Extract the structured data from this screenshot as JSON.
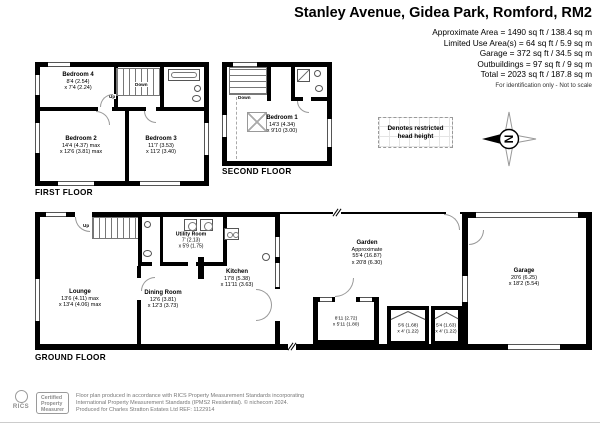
{
  "header": {
    "title": "Stanley Avenue, Gidea Park, Romford, RM2",
    "area_lines": [
      "Approximate Area = 1490 sq ft / 138.4 sq m",
      "Limited Use Area(s) = 64 sq ft / 5.9 sq m",
      "Garage = 372 sq ft / 34.5 sq m",
      "Outbuildings = 97 sq ft / 9 sq m",
      "Total = 2023 sq ft / 187.8 sq m"
    ],
    "disclaimer": "For identification only - Not to scale"
  },
  "legend": {
    "restricted_line1": "Denotes restricted",
    "restricted_line2": "head height",
    "compass_letter": "N"
  },
  "floors": {
    "first": {
      "label": "FIRST FLOOR",
      "up": "Up",
      "down": "Down",
      "bedroom4": {
        "name": "Bedroom 4",
        "dim1": "8'4 (2.54)",
        "dim2": "x 7'4 (2.24)"
      },
      "bedroom2": {
        "name": "Bedroom 2",
        "dim1": "14'4 (4.37) max",
        "dim2": "x 12'6 (3.81) max"
      },
      "bedroom3": {
        "name": "Bedroom 3",
        "dim1": "11'7 (3.53)",
        "dim2": "x 11'2 (3.40)"
      }
    },
    "second": {
      "label": "SECOND FLOOR",
      "down": "Down",
      "bedroom1": {
        "name": "Bedroom 1",
        "dim1": "14'3 (4.34)",
        "dim2": "x 9'10 (3.00)"
      }
    },
    "ground": {
      "label": "GROUND FLOOR",
      "up": "Up",
      "lounge": {
        "name": "Lounge",
        "dim1": "13'6 (4.11) max",
        "dim2": "x 13'4 (4.06) max"
      },
      "dining": {
        "name": "Dining Room",
        "dim1": "12'6 (3.81)",
        "dim2": "x 12'3 (3.73)"
      },
      "kitchen": {
        "name": "Kitchen",
        "dim1": "17'8 (5.38)",
        "dim2": "x 11'11 (3.63)"
      },
      "utility": {
        "name": "Utility Room",
        "dim1": "7' (2.13)",
        "dim2": "x 5'9 (1.75)"
      },
      "garden": {
        "name": "Garden",
        "approx": "Approximate",
        "dim1": "55'4 (16.87)",
        "dim2": "x 20'8 (6.30)"
      },
      "garage": {
        "name": "Garage",
        "dim1": "20'6 (6.25)",
        "dim2": "x 18'2 (5.54)"
      },
      "outbuilding1": {
        "dim1": "8'11 (2.72)",
        "dim2": "x 5'11 (1.80)"
      },
      "outbuilding2": {
        "dim1": "5'6 (1.68)",
        "dim2": "x 4' (1.22)"
      },
      "outbuilding3": {
        "dim1": "5'4 (1.63)",
        "dim2": "x 4' (1.22)"
      }
    }
  },
  "footer": {
    "rics_label": "RICS",
    "certified_lines": [
      "Certified",
      "Property",
      "Measurer"
    ],
    "lines": [
      "Floor plan produced in accordance with RICS Property Measurement Standards incorporating",
      "International Property Measurement Standards (IPMS2 Residential).  © nichecom 2024.",
      "Produced for Charles Stratton Estates Ltd   REF: 1122914"
    ]
  }
}
